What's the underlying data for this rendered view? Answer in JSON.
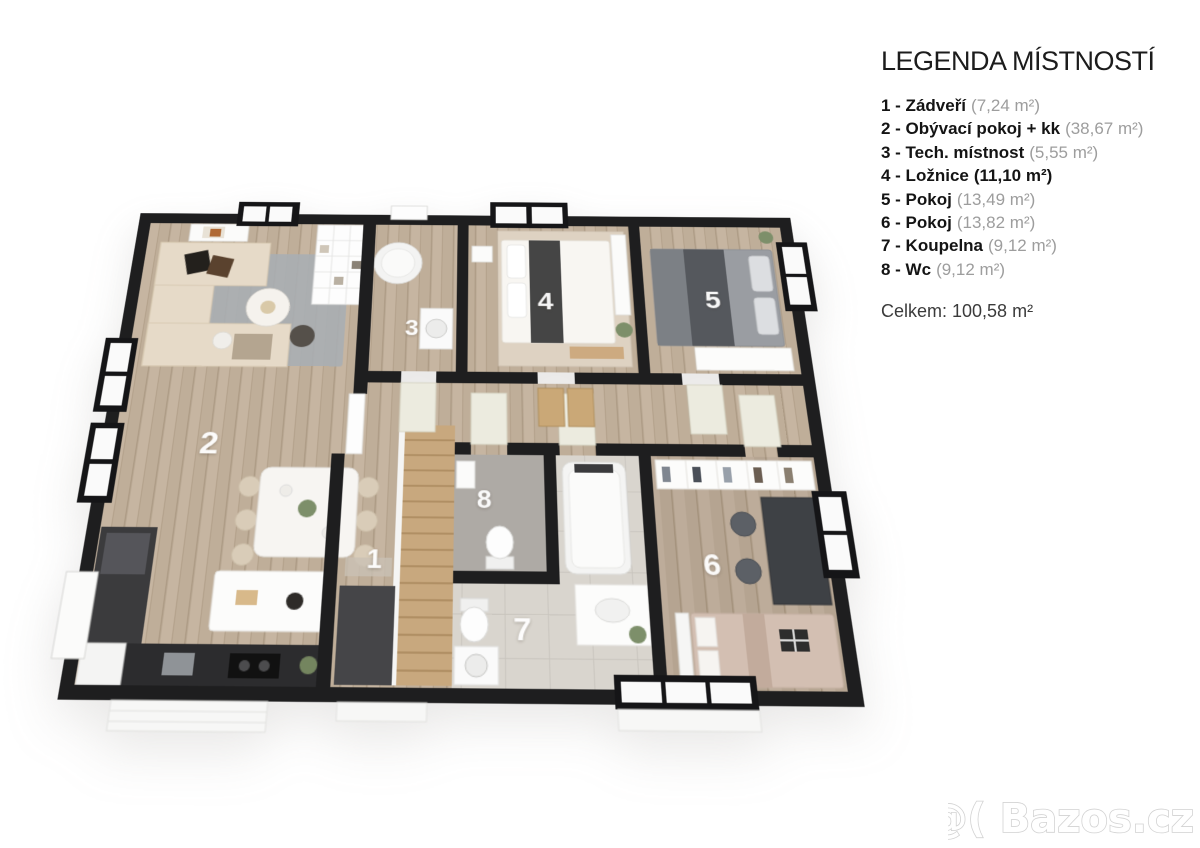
{
  "legend": {
    "title": "LEGENDA MÍSTNOSTÍ",
    "items": [
      {
        "label": "1 - Zádveří",
        "area": "(7,24 m²)"
      },
      {
        "label": "2 - Obývací pokoj + kk",
        "area": "(38,67 m²)"
      },
      {
        "label": "3 - Tech. místnost",
        "area": "(5,55 m²)"
      },
      {
        "label": "4 - Ložnice",
        "area": "(11,10 m²)"
      },
      {
        "label": "5 - Pokoj",
        "area": "(13,49 m²)"
      },
      {
        "label": "6 - Pokoj",
        "area": "(13,82 m²)"
      },
      {
        "label": "7 - Koupelna",
        "area": "(9,12 m²)"
      },
      {
        "label": "8 - Wc",
        "area": "(9,12 m²)"
      }
    ],
    "total": "Celkem: 100,58 m²"
  },
  "floorplan": {
    "room_numbers": [
      "1",
      "2",
      "3",
      "4",
      "5",
      "6",
      "7",
      "8"
    ]
  },
  "watermark": {
    "text": "@( Bazos.cz"
  },
  "colors": {
    "wall": "#1e1e1f",
    "wood_floor": "#c6b5a1",
    "wood_floor_dark": "#bdac9a",
    "tile_floor": "#d9d5ce",
    "wc_floor": "#aeaaa5",
    "carpet": "#dbcfc0",
    "legend_text": "#141414",
    "legend_area_gray": "#9d9d9d",
    "watermark_outline": "#d2d2d2"
  }
}
